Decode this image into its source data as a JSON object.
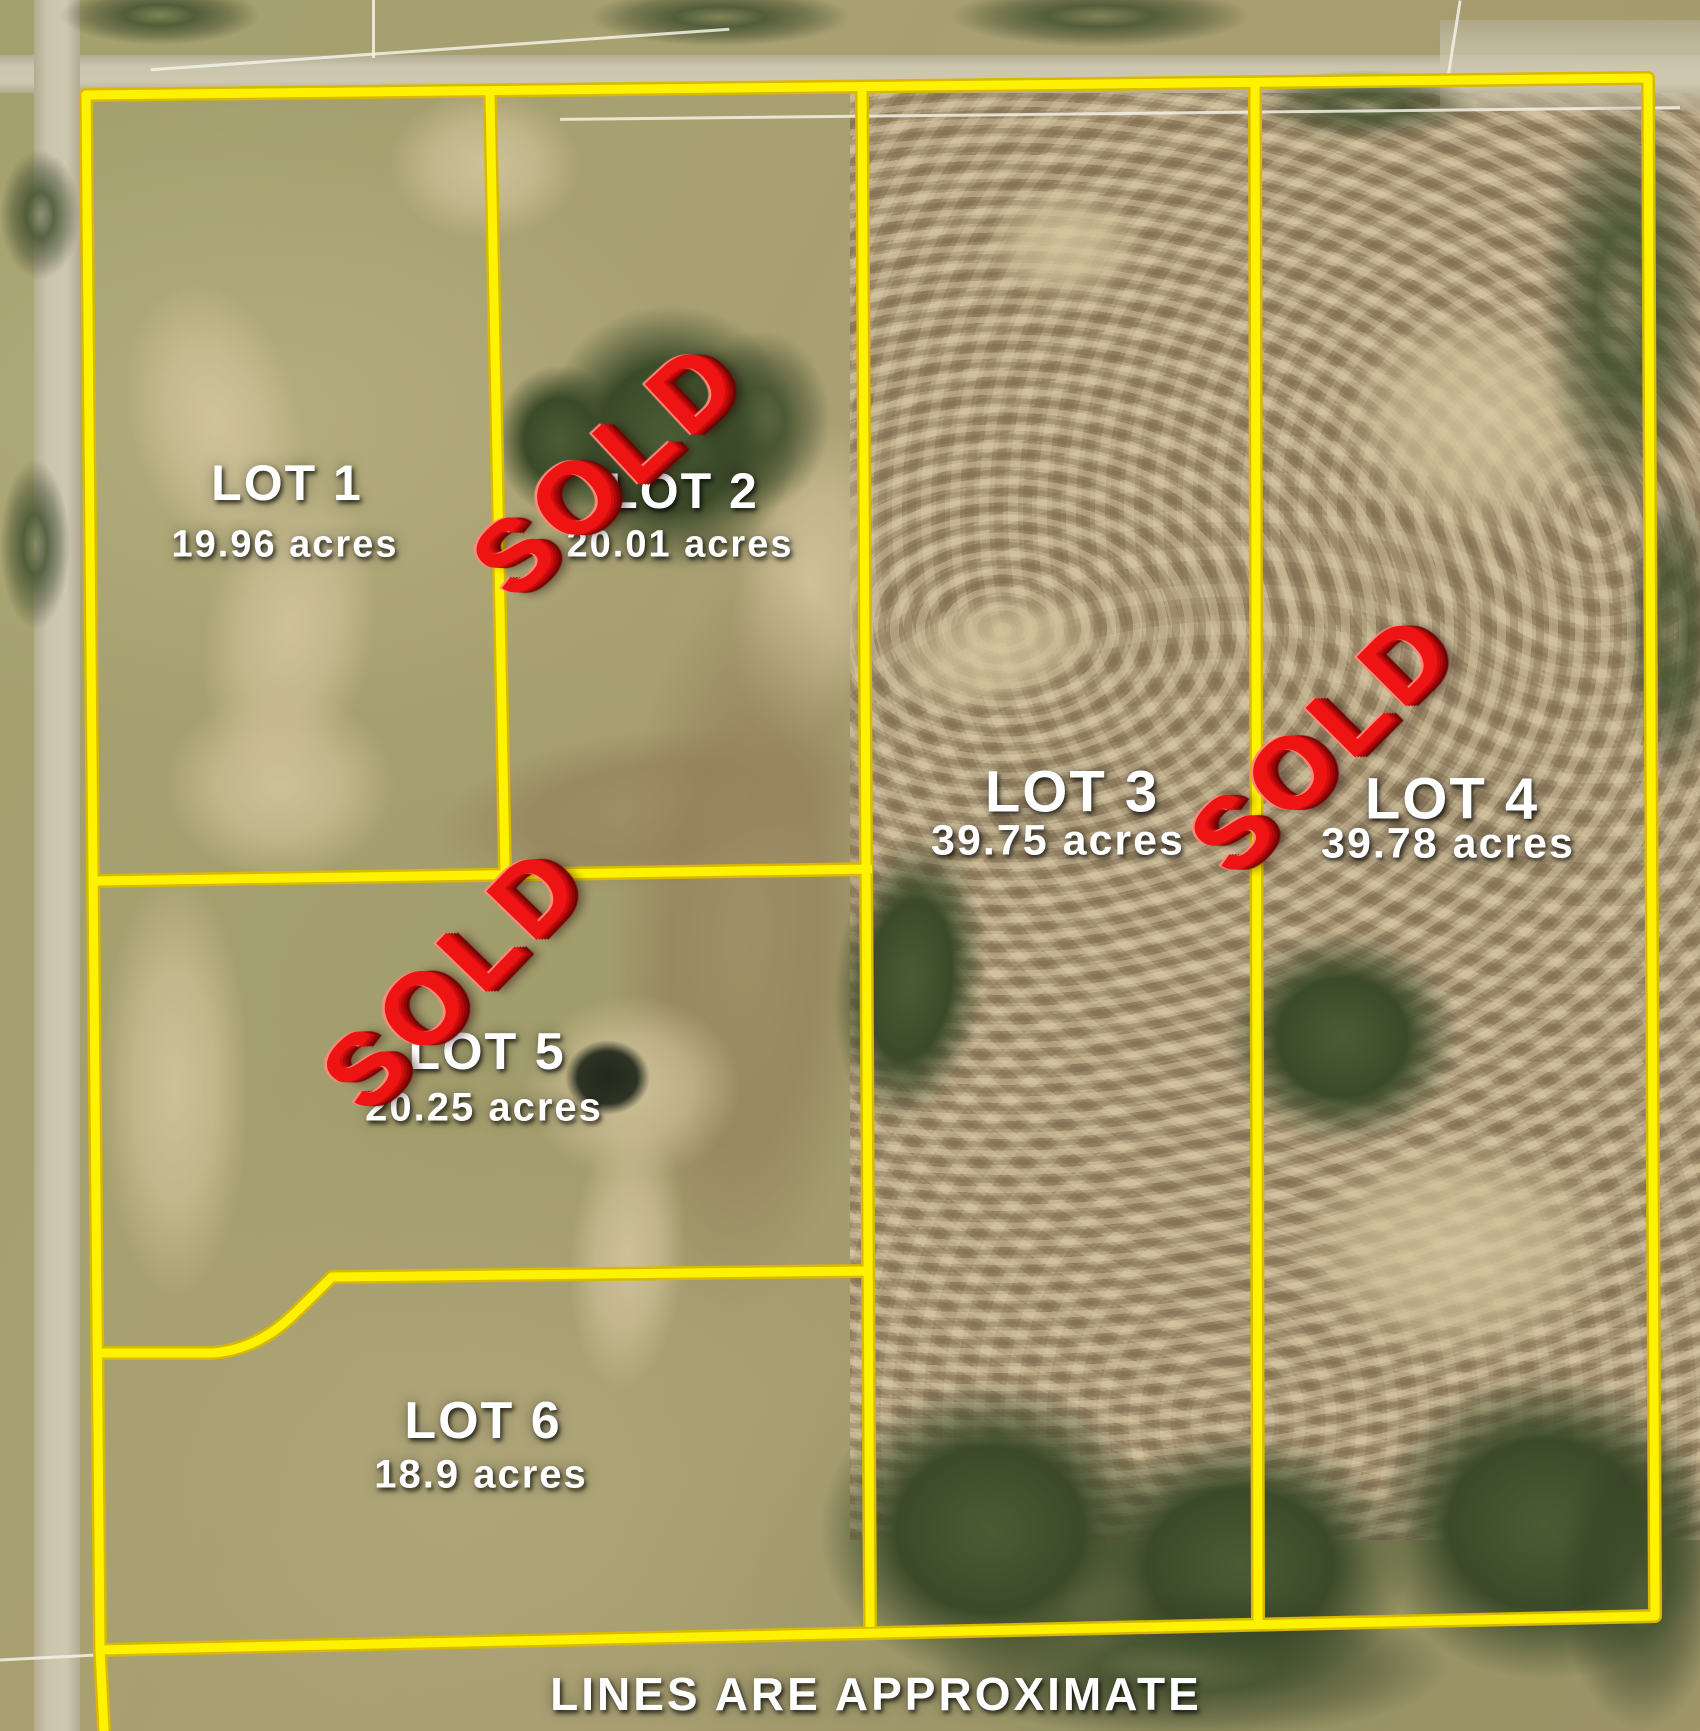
{
  "map": {
    "disclaimer": "LINES ARE APPROXIMATE",
    "sold_label": "SOLD",
    "lots": [
      {
        "id": "lot-1",
        "name": "LOT 1",
        "acres": "19.96 acres",
        "sold": false
      },
      {
        "id": "lot-2",
        "name": "LOT 2",
        "acres": "20.01 acres",
        "sold": true
      },
      {
        "id": "lot-3",
        "name": "LOT 3",
        "acres": "39.75 acres",
        "sold": false
      },
      {
        "id": "lot-4",
        "name": "LOT 4",
        "acres": "39.78 acres",
        "sold": true
      },
      {
        "id": "lot-5",
        "name": "LOT 5",
        "acres": "20.25 acres",
        "sold": true
      },
      {
        "id": "lot-6",
        "name": "LOT 6",
        "acres": "18.9 acres",
        "sold": false
      }
    ],
    "colors": {
      "boundary_line": "#fff200",
      "sold_stamp": "#ee1414",
      "label_text": "#ffffff"
    }
  }
}
